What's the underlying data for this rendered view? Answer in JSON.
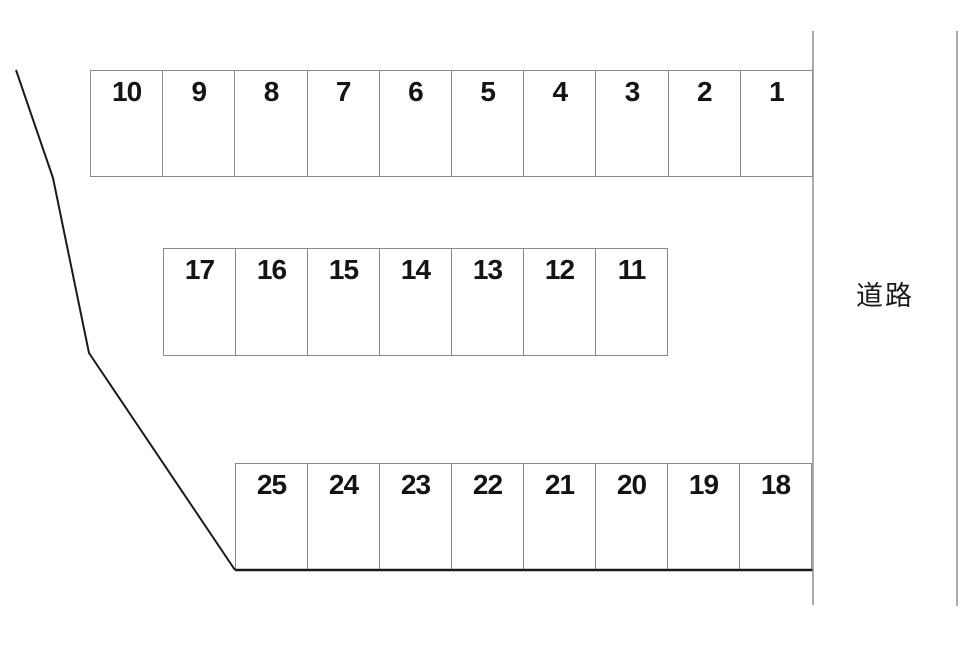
{
  "road": {
    "label": "道路"
  },
  "rows": [
    {
      "id": "top",
      "cells": [
        "10",
        "9",
        "8",
        "7",
        "6",
        "5",
        "4",
        "3",
        "2",
        "1"
      ]
    },
    {
      "id": "middle",
      "cells": [
        "17",
        "16",
        "15",
        "14",
        "13",
        "12",
        "11"
      ]
    },
    {
      "id": "bottom",
      "cells": [
        "25",
        "24",
        "23",
        "22",
        "21",
        "20",
        "19",
        "18"
      ]
    }
  ],
  "colors": {
    "background": "#ffffff",
    "cell_border": "#8a8a8a",
    "property_boundary": "#1a1a1a",
    "road_line": "#8f8f8f",
    "number_text": "#141414"
  }
}
